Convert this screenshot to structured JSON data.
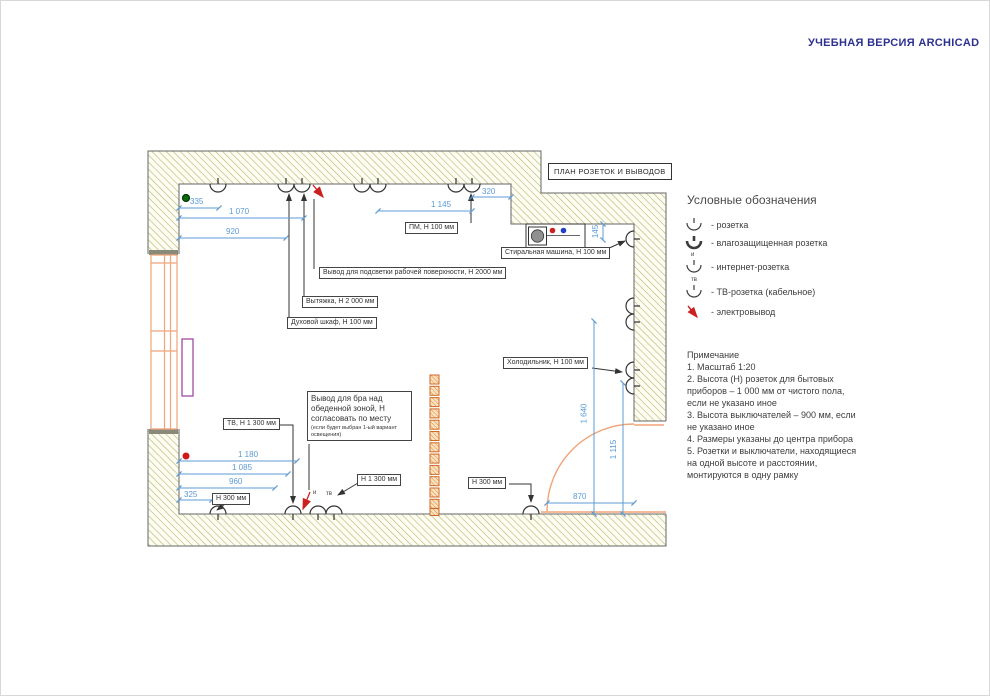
{
  "watermark": "УЧЕБНАЯ ВЕРСИЯ ARCHICAD",
  "plan": {
    "title_box": "ПЛАН РОЗЕТОК И ВЫВОДОВ",
    "labels": {
      "pm": "ПМ, Н 100 мм",
      "worklight": "Вывод для подсветки рабочей поверхности, Н 2000 мм",
      "hood": "Вытяжка, Н 2 000 мм",
      "oven": "Духовой шкаф, Н 100 мм",
      "washer": "Стиральная машина, Н 100 мм",
      "fridge": "Холодильник, Н 100 мм",
      "tv": "ТВ, Н 1 300 мм",
      "sconce_main": "Вывод для бра над обеденной зоной, Н согласовать по месту",
      "sconce_note": "(если будет выбран 1-ый вариант освещения)",
      "h300_left": "Н 300 мм",
      "h1300_bottom": "Н 1 300 мм",
      "h300_right": "Н 300 мм",
      "internet_mark": "и",
      "tv_mark": "тв"
    },
    "dimensions": {
      "d335": "335",
      "d1070": "1 070",
      "d920": "920",
      "d1145": "1 145",
      "d320": "320",
      "d145": "145",
      "d1640": "1 640",
      "d1115": "1 115",
      "d870": "870",
      "d1180": "1 180",
      "d1085": "1 085",
      "d960": "960",
      "d325": "325"
    }
  },
  "legend": {
    "title": "Условные обозначения",
    "items": [
      {
        "icon": "socket-icon",
        "mark": "",
        "label": "- розетка"
      },
      {
        "icon": "waterproof-socket-icon",
        "mark": "",
        "label": "- влагозащищенная розетка"
      },
      {
        "icon": "internet-socket-icon",
        "mark": "и",
        "label": "- интернет-розетка"
      },
      {
        "icon": "tv-socket-icon",
        "mark": "тв",
        "label": "- ТВ-розетка (кабельное)"
      },
      {
        "icon": "electrical-outlet-arrow-icon",
        "mark": "",
        "label": "- электровывод"
      }
    ]
  },
  "notes": {
    "title": "Примечание",
    "items": [
      "1. Масштаб 1:20",
      "2. Высота (Н) розеток для бытовых приборов – 1 000 мм от чистого пола, если не указано иное",
      "3. Высота выключателей – 900 мм, если не указано иное",
      "4. Размеры указаны до центра прибора",
      "5. Розетки и выключатели, находящиеся на одной высоте и расстоянии, монтируются в одну рамку"
    ]
  },
  "colors": {
    "dimension_blue": "#5b9bd5",
    "wall_hatch_olive": "#b6b66a",
    "door_window_orange": "#f0a478",
    "outlet_red": "#cc2020",
    "watermark_navy": "#2e3192",
    "radiator_purple": "#a04aa0",
    "ceiling_dot_green": "#0c6b0c"
  }
}
